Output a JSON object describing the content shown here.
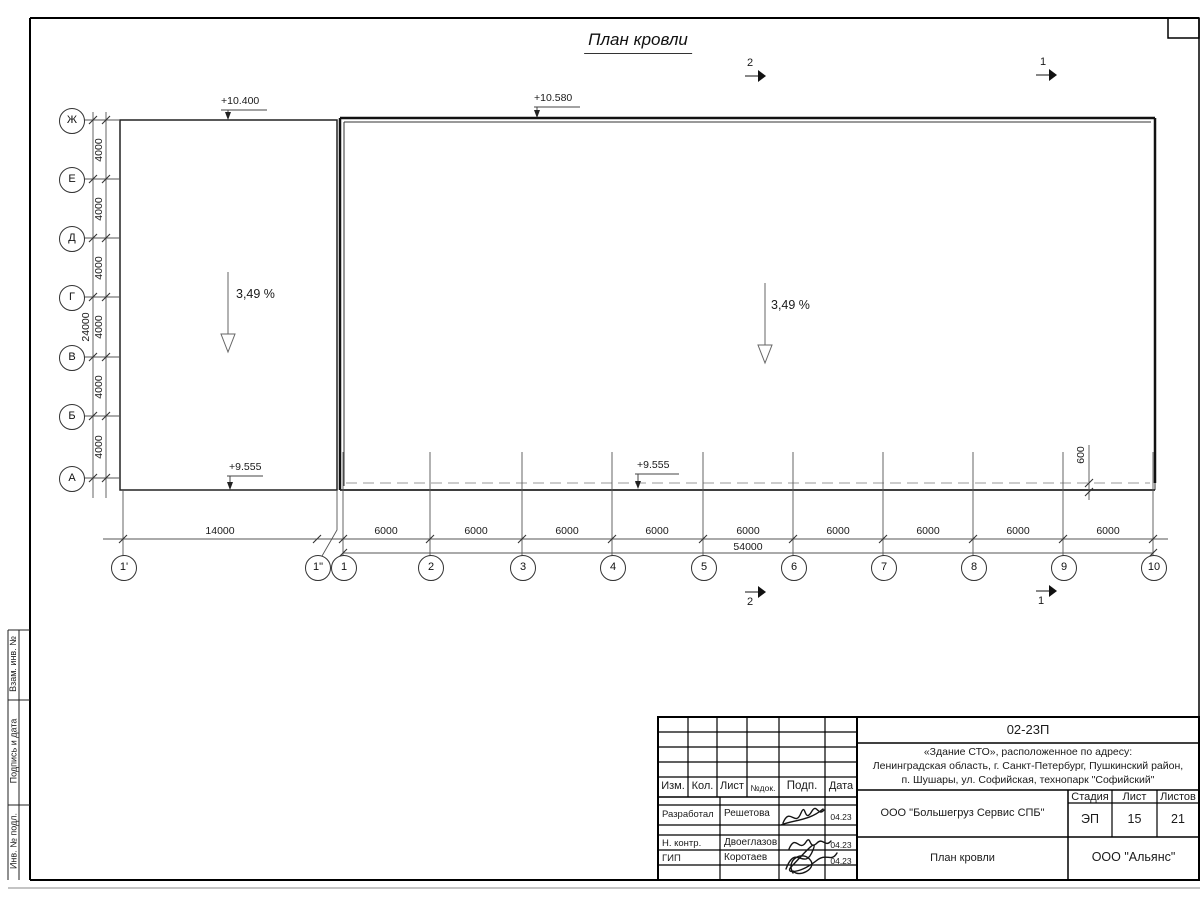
{
  "sheet": {
    "title": "План кровли"
  },
  "elevations": {
    "annex_top": "+10.400",
    "main_top": "+10.580",
    "annex_bottom": "+9.555",
    "main_bottom": "+9.555"
  },
  "slopes": {
    "left": "3,49 %",
    "right": "3,49 %"
  },
  "grid": {
    "letters": [
      "Ж",
      "Е",
      "Д",
      "Г",
      "В",
      "Б",
      "А"
    ],
    "numbers": [
      "1'",
      "1\"",
      "1",
      "2",
      "3",
      "4",
      "5",
      "6",
      "7",
      "8",
      "9",
      "10"
    ]
  },
  "dimensions": {
    "left_segments": [
      "4000",
      "4000",
      "4000",
      "4000",
      "4000",
      "4000"
    ],
    "left_total": "24000",
    "bottom_segments": [
      "14000",
      "6000",
      "6000",
      "6000",
      "6000",
      "6000",
      "6000",
      "6000",
      "6000",
      "6000"
    ],
    "bottom_total": "54000",
    "overhang": "600"
  },
  "section_marks": {
    "top_left": "2",
    "top_right": "1",
    "bottom_left": "2",
    "bottom_right": "1"
  },
  "side_stamp": {
    "cells": [
      "Взам. инв. №",
      "Подпись и дата",
      "Инв. № подл."
    ]
  },
  "title_block": {
    "doc_number": "02-23П",
    "project_address_lines": [
      "«Здание СТО», расположенное по адресу:",
      "Ленинградская область, г. Санкт-Петербург, Пушкинский район,",
      "п. Шушары, ул. Софийская, технопарк \"Софийский\""
    ],
    "client": "ООО \"Большегруз Сервис СПБ\"",
    "drawing_title": "План кровли",
    "company": "ООО \"Альянс\"",
    "stage_label": "Стадия",
    "sheet_label": "Лист",
    "sheets_label": "Листов",
    "stage": "ЭП",
    "sheet_number": "15",
    "sheets_total": "21",
    "header_cols": [
      "Изм.",
      "Кол.",
      "Лист",
      "№док.",
      "Подп.",
      "Дата"
    ],
    "signature_rows": [
      {
        "role": "Разработал",
        "name": "Решетова",
        "date": "04.23"
      },
      {
        "role": "Н. контр.",
        "name": "Двоеглазов",
        "date": "04.23"
      },
      {
        "role": "ГИП",
        "name": "Коротаев",
        "date": "04.23"
      }
    ]
  }
}
